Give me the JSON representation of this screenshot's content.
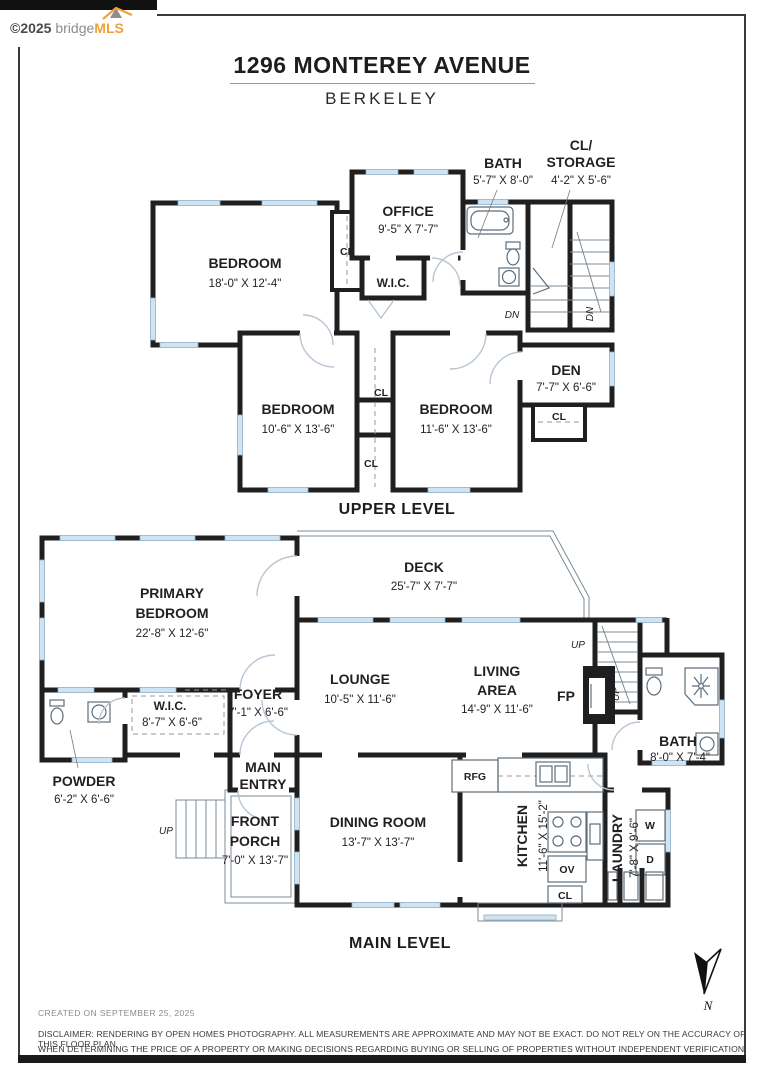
{
  "page": {
    "logo": {
      "copyright": "©2025",
      "brand_gray": "bridge",
      "brand_accent": "MLS"
    },
    "title": "1296 MONTEREY AVENUE",
    "subtitle": "BERKELEY"
  },
  "upper_level": {
    "caption": "UPPER LEVEL",
    "rooms": {
      "bedroom_large": {
        "name": "BEDROOM",
        "dims": "18'-0\" X 12'-4\""
      },
      "office": {
        "name": "OFFICE",
        "dims": "9'-5\" X 7'-7\""
      },
      "bath": {
        "name": "BATH",
        "dims": "5'-7\" X 8'-0\""
      },
      "cl_storage": {
        "name_line1": "CL/",
        "name_line2": "STORAGE",
        "dims": "4'-2\" X 5'-6\""
      },
      "wic": {
        "name": "W.I.C."
      },
      "den": {
        "name": "DEN",
        "dims": "7'-7\" X 6'-6\""
      },
      "bedroom_left": {
        "name": "BEDROOM",
        "dims": "10'-6\" X 13'-6\""
      },
      "bedroom_right": {
        "name": "BEDROOM",
        "dims": "11'-6\" X 13'-6\""
      }
    }
  },
  "main_level": {
    "caption": "MAIN LEVEL",
    "rooms": {
      "primary_bedroom": {
        "name_line1": "PRIMARY",
        "name_line2": "BEDROOM",
        "dims": "22'-8\" X 12'-6\""
      },
      "deck": {
        "name": "DECK",
        "dims": "25'-7\" X 7'-7\""
      },
      "lounge": {
        "name": "LOUNGE",
        "dims": "10'-5\" X 11'-6\""
      },
      "living_area": {
        "name_line1": "LIVING",
        "name_line2": "AREA",
        "dims": "14'-9\" X 11'-6\""
      },
      "foyer": {
        "name": "FOYER",
        "dims": "7'-1\" X 6'-6\""
      },
      "wic": {
        "name": "W.I.C.",
        "dims": "8'-7\" X 6'-6\""
      },
      "powder": {
        "name": "POWDER",
        "dims": "6'-2\" X 6'-6\""
      },
      "main_entry": {
        "name_line1": "MAIN",
        "name_line2": "ENTRY"
      },
      "front_porch": {
        "name_line1": "FRONT",
        "name_line2": "PORCH",
        "dims": "7'-0\" X 13'-7\""
      },
      "dining_room": {
        "name": "DINING ROOM",
        "dims": "13'-7\" X 13'-7\""
      },
      "kitchen": {
        "name": "KITCHEN",
        "dims": "11'-6\" X 15'-2\""
      },
      "laundry": {
        "name": "LAUNDRY",
        "dims": "7'-8\" X 9'-6\""
      },
      "bath": {
        "name": "BATH",
        "dims": "8'-0\" X 7'-4\""
      }
    },
    "fixtures": {
      "fp": "FP",
      "rfg": "RFG",
      "ov": "OV",
      "washer": "W",
      "dryer": "D"
    }
  },
  "labels": {
    "cl": "CL",
    "dn": "DN",
    "up": "UP"
  },
  "compass": {
    "north": "N"
  },
  "footer": {
    "created": "CREATED ON SEPTEMBER 25, 2025",
    "disclaimer_line1": "DISCLAIMER: RENDERING BY OPEN HOMES PHOTOGRAPHY. ALL MEASUREMENTS ARE APPROXIMATE AND MAY NOT BE EXACT. DO NOT RELY ON THE ACCURACY OF THIS FLOOR PLAN",
    "disclaimer_line2": "WHEN DETERMINING THE PRICE OF A PROPERTY OR MAKING DECISIONS REGARDING BUYING OR SELLING OF PROPERTIES WITHOUT INDEPENDENT VERIFICATION."
  },
  "colors": {
    "wall": "#1f1f1f",
    "window": "#cfe3f1",
    "accent_orange": "#f0a13c",
    "text": "#231f20",
    "muted": "#8b8b8b"
  }
}
